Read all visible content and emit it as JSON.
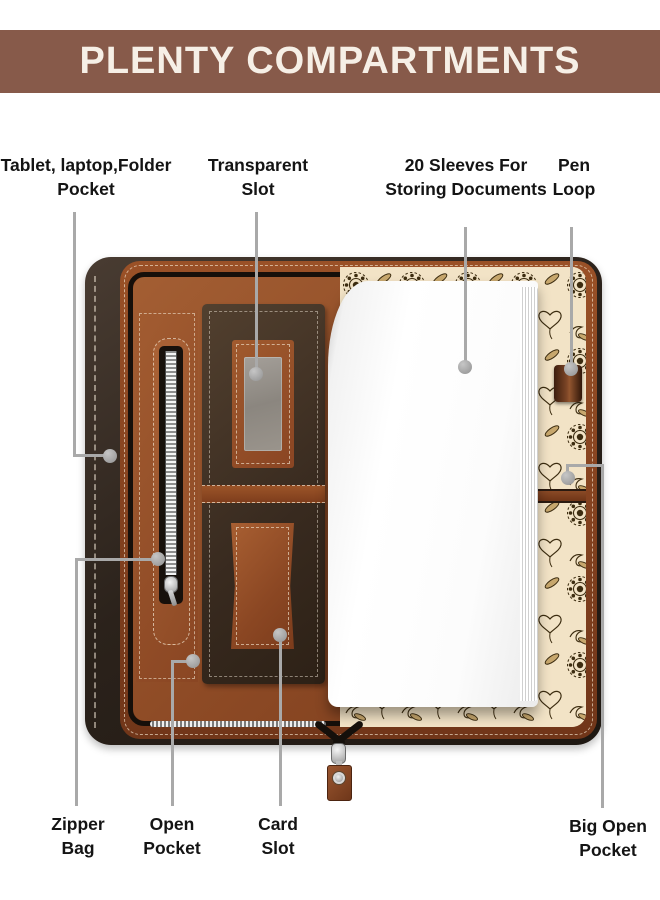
{
  "banner": {
    "title": "PLENTY COMPARTMENTS"
  },
  "callouts": {
    "tablet_pocket": {
      "line1": "Tablet, laptop,Folder",
      "line2": "Pocket"
    },
    "transparent_slot": {
      "line1": "Transparent",
      "line2": "Slot"
    },
    "sleeves": {
      "line1": "20 Sleeves For",
      "line2": "Storing Documents"
    },
    "pen_loop": {
      "line1": "Pen",
      "line2": "Loop"
    },
    "zipper_bag": {
      "line1": "Zipper",
      "line2": "Bag"
    },
    "open_pocket": {
      "line1": "Open",
      "line2": "Pocket"
    },
    "card_slot": {
      "line1": "Card",
      "line2": "Slot"
    },
    "big_open_pocket": {
      "line1": "Big Open",
      "line2": "Pocket"
    }
  },
  "colors": {
    "banner_bg": "#875a4a",
    "banner_text": "#f6efe6",
    "label_text": "#141414",
    "callout_line": "#a9a9a9",
    "leather_tan": "#9a5228",
    "leather_dark": "#2a211b",
    "pocket_panel_dark": "#3d2e21",
    "floral_cream": "#f2e3c6",
    "pages_white": "#ffffff"
  }
}
